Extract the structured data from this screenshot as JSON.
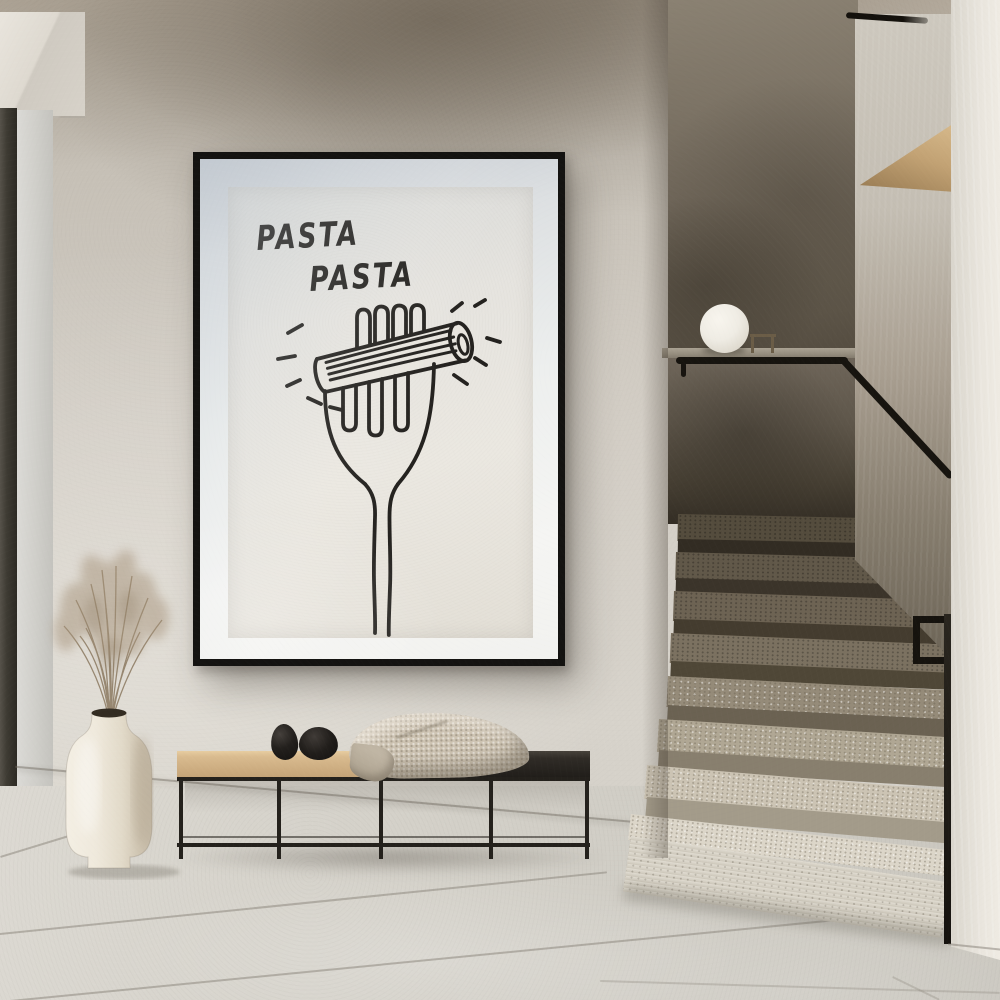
{
  "scene": {
    "setting": "minimalist-hallway-with-staircase",
    "poster": {
      "title_line1": "PASTA",
      "title_line2": "PASTA",
      "subject": "penne-on-fork-line-drawing",
      "frame_color": "#141311",
      "mat_color": "#eef0ef",
      "paper_color": "#e8e5de",
      "ink_color": "#24221f"
    },
    "objects": {
      "bench": {
        "seat_left_color": "#d6b88c",
        "seat_right_color": "#2b2723",
        "frame_color": "#24211c"
      },
      "decor_stones": {
        "count": 2,
        "color": "#1d1a17"
      },
      "blanket": {
        "color": "#cdc3b2"
      },
      "vase": {
        "color": "#efe9dc",
        "contents": "dried-pampas-grass",
        "grass_color": "#a6937a"
      },
      "sphere_lamp": {
        "color": "#f2efe7"
      },
      "staircase": {
        "lower_steps_color": "#d5cfc2",
        "upper_steps_color": "#5e5646",
        "handrail_color": "#17140f"
      },
      "floor": {
        "color": "#d5d2cb"
      },
      "walls": {
        "plaster_color": "#cfcac2",
        "dark_wall_color": "#6e6558",
        "door_frame_color": "#3e3b33"
      }
    }
  }
}
